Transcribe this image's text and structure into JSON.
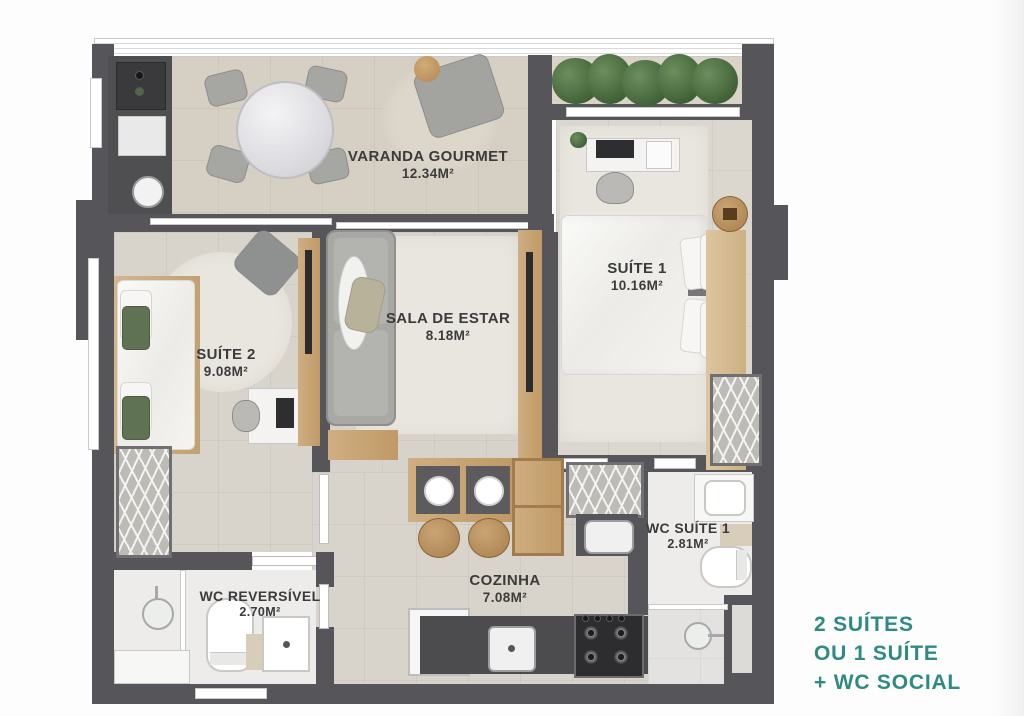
{
  "rooms": {
    "varanda": {
      "name": "VARANDA GOURMET",
      "area": "12.34M²"
    },
    "suite1": {
      "name": "SUÍTE 1",
      "area": "10.16M²"
    },
    "suite2": {
      "name": "SUÍTE 2",
      "area": "9.08M²"
    },
    "sala": {
      "name": "SALA DE ESTAR",
      "area": "8.18M²"
    },
    "cozinha": {
      "name": "COZINHA",
      "area": "7.08M²"
    },
    "wc_suite1": {
      "name": "WC SUÍTE 1",
      "area": "2.81M²"
    },
    "wc_reversivel": {
      "name": "WC REVERSÍVEL",
      "area": "2.70M²"
    }
  },
  "tagline": {
    "line1": "2 SUÍTES",
    "line2": "OU 1 SUÍTE",
    "line3": "+ WC SOCIAL",
    "color": "#2f8a84"
  },
  "colors": {
    "wall": "#56565a",
    "accent": "#2f8a84",
    "floor_varanda": "#d6cfc3",
    "floor_room": "#d9d3ca",
    "floor_wet": "#edecea",
    "wood": "#c9a87b",
    "plants": "#46683c"
  }
}
